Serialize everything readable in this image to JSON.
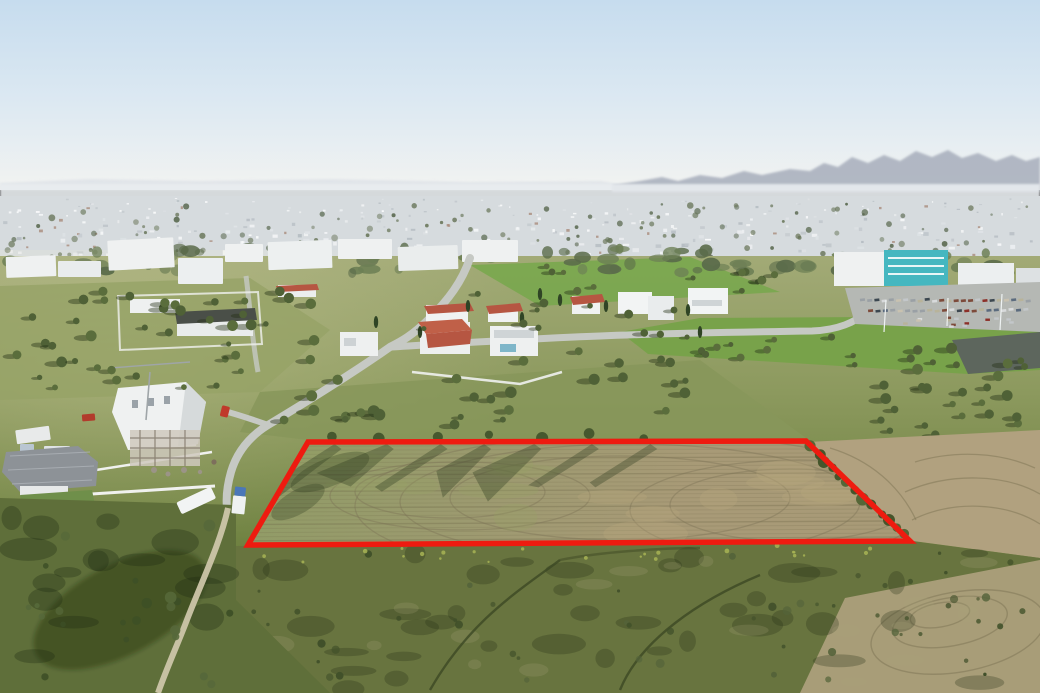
{
  "image": {
    "kind": "aerial-drone-photograph",
    "description": "Aerial view of suburban outskirts (Nicosia-style, Cyprus) with a hazy mountain range on the horizon, dense white low-rise city sprawl, villas with red tile roofs, green fields with scattered olive trees, a construction site, roads, a commercial building with parking, and a large farmland plot outlined with a thick red boundary line",
    "width": 1040,
    "height": 693
  },
  "colors": {
    "sky_top": "#c6dcee",
    "sky_mid": "#dde9f2",
    "sky_horizon": "#f2f3f1",
    "mountains_far": "#d9dee5",
    "mountains": "#a7aebc",
    "haze": "#e9edf0",
    "city_base": "#d6dbde",
    "city_white": "#f8f9fa",
    "city_grey": "#c2c8cd",
    "city_tree": "#677457",
    "treeline": "#5a6b4a",
    "ground_top": "#a2aa76",
    "ground_mid": "#8d9a5f",
    "ground_low": "#6e8140",
    "ground_deep": "#5e7036",
    "lawn_green": "#79a74e",
    "field_green": "#78a24a",
    "plot_green": "#8e9c64",
    "plot_mid": "#9d9a70",
    "plot_tan": "#a89a77",
    "right_tan": "#b1a17f",
    "bottom_tan": "#a89d78",
    "scrub": "#68743f",
    "slope_green": "#5f6f3a",
    "road": "#c6c9c4",
    "dirt_path": "#ccc5a9",
    "wall_white": "#f0f1ef",
    "building_white": "#eff1f1",
    "building_shade": "#d6dadb",
    "roof_red": "#b65642",
    "roof_grey": "#8d9297",
    "roof_dark": "#4a4f48",
    "teal_building": "#45b7c0",
    "fence_dark": "#585c60",
    "plot_outline": "#ee1b10",
    "truck_blue": "#4a77b8",
    "car_red": "#c0392b",
    "dumpster_red": "#b23b2c",
    "olive_tree": "#4f6136",
    "bush_dark": "#41502a",
    "plow_line": "#6f6848"
  },
  "plot_outline": {
    "stroke_width": 5.5,
    "points": [
      [
        308,
        442
      ],
      [
        806,
        441
      ],
      [
        910,
        541
      ],
      [
        248,
        545
      ]
    ]
  },
  "landmarks": [
    {
      "name": "mountain-range",
      "area": "top right horizon"
    },
    {
      "name": "city-sprawl-band",
      "area": "upper third"
    },
    {
      "name": "industrial-warehouses",
      "area": "upper left"
    },
    {
      "name": "red-roof-villas",
      "area": "center"
    },
    {
      "name": "teal-commercial-building",
      "area": "upper right"
    },
    {
      "name": "car-parking-lot",
      "area": "upper right"
    },
    {
      "name": "construction-site",
      "area": "left middle"
    },
    {
      "name": "grey-roof-house",
      "area": "lower left"
    },
    {
      "name": "road-junction",
      "area": "center left"
    },
    {
      "name": "white-truck",
      "area": "left of plot"
    },
    {
      "name": "blue-truck",
      "area": "left of plot"
    },
    {
      "name": "outlined-land-plot",
      "area": "lower center"
    },
    {
      "name": "olive-grove",
      "area": "right slope"
    },
    {
      "name": "scrubland-foreground",
      "area": "bottom"
    }
  ]
}
